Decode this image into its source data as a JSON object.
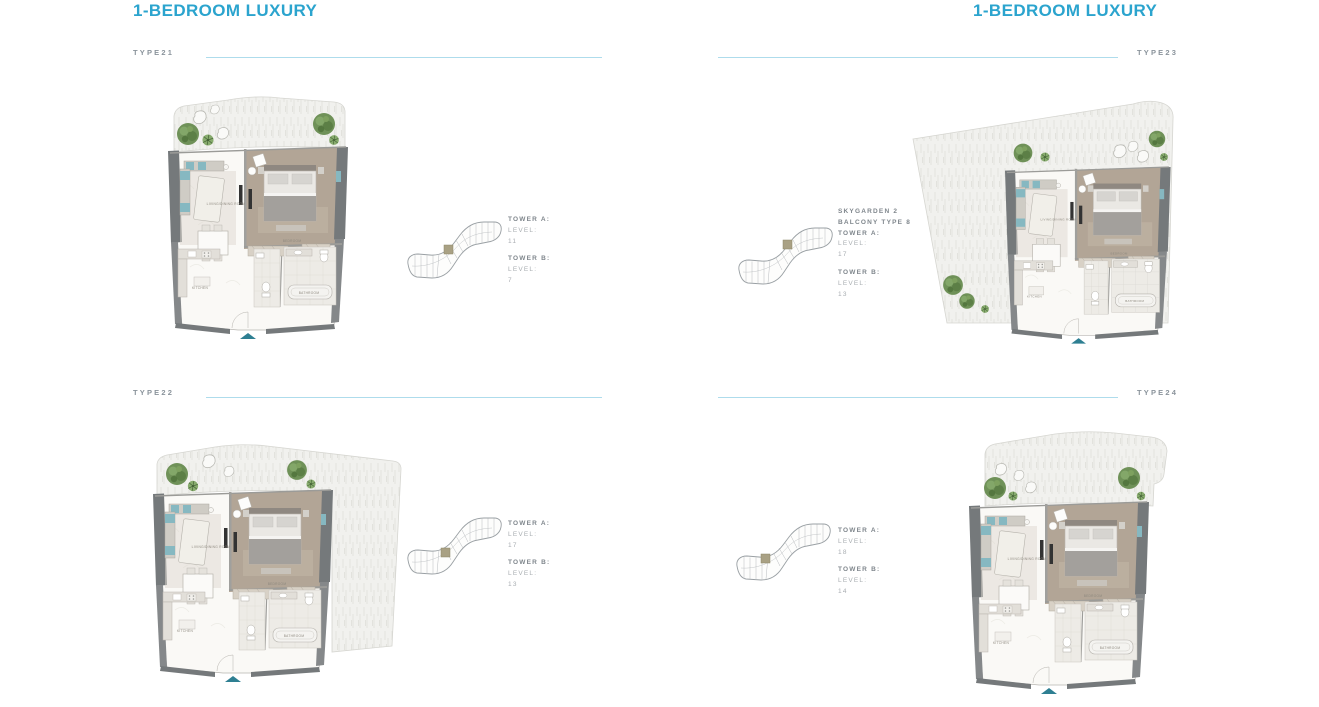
{
  "page": {
    "header_left": "1-BEDROOM LUXURY",
    "header_right": "1-BEDROOM LUXURY",
    "accent_color": "#2ba4ce",
    "rule_color": "#aedcec",
    "entry_arrow_color": "#2e7f92"
  },
  "room_labels": {
    "living": "LIVING/DINING ROOM",
    "bedroom": "BEDROOM",
    "kitchen": "KITCHEN",
    "bathroom": "BATHROOM"
  },
  "units": [
    {
      "label": "TYPE21",
      "key": {
        "tower_a": "TOWER A:",
        "level_label_a": "LEVEL:",
        "level_a": "11",
        "tower_b": "TOWER B:",
        "level_label_b": "LEVEL:",
        "level_b": "7"
      }
    },
    {
      "label": "TYPE22",
      "key": {
        "tower_a": "TOWER A:",
        "level_label_a": "LEVEL:",
        "level_a": "17",
        "tower_b": "TOWER B:",
        "level_label_b": "LEVEL:",
        "level_b": "13"
      }
    },
    {
      "label": "TYPE23",
      "key": {
        "extra_1": "SKYGARDEN 2",
        "extra_2": "BALCONY TYPE 8",
        "tower_a": "TOWER A:",
        "level_label_a": "LEVEL:",
        "level_a": "17",
        "tower_b": "TOWER B:",
        "level_label_b": "LEVEL:",
        "level_b": "13"
      }
    },
    {
      "label": "TYPE24",
      "key": {
        "tower_a": "TOWER A:",
        "level_label_a": "LEVEL:",
        "level_a": "18",
        "tower_b": "TOWER B:",
        "level_label_b": "LEVEL:",
        "level_b": "14"
      }
    }
  ]
}
